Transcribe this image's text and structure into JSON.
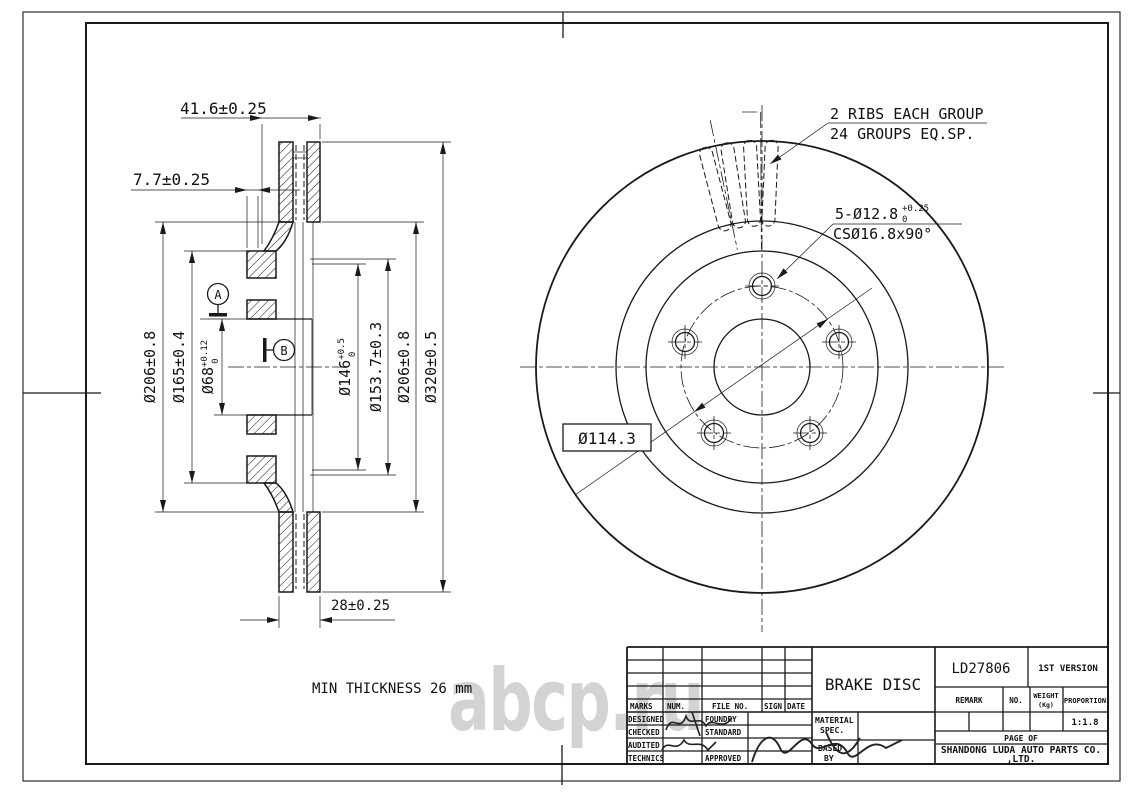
{
  "watermark": "abcp.ru",
  "colors": {
    "line_color": "#1a1a1a",
    "watermark_color": "#b0b0b0"
  },
  "section_view": {
    "dims": {
      "hat_depth": "41.6±0.25",
      "flange_thickness": "7.7±0.25",
      "d206_left": "Ø206±0.8",
      "d165": "Ø165±0.4",
      "d68_base": "Ø68",
      "d68_sup": "+0.12",
      "d68_sub": "0",
      "d146_base": "Ø146",
      "d146_sup": "+0.5",
      "d146_sub": "0",
      "d153_7": "Ø153.7±0.3",
      "d206_right": "Ø206±0.8",
      "d320": "Ø320±0.5",
      "disc_thickness": "28±0.25"
    },
    "datum_a": "A",
    "datum_b": "B",
    "note_min_thickness": "MIN THICKNESS 26 mm"
  },
  "front_view": {
    "ribs_note_line1": "2 RIBS EACH GROUP",
    "ribs_note_line2": "24 GROUPS EQ.SP.",
    "holes_base": "5-Ø12.8",
    "holes_sup": "+0.25",
    "holes_sub": "0",
    "countersink": "CSØ16.8x90°",
    "bolt_circle": "Ø114.3"
  },
  "title_block": {
    "part_name": "BRAKE DISC",
    "drawing_no": "LD27806",
    "version": "1ST VERSION",
    "col_remark": "REMARK",
    "col_no": "NO.",
    "col_weight_1": "WEIGHT",
    "col_weight_2": "(Kg)",
    "col_proportion": "PROPORTION",
    "proportion_value": "1:1.8",
    "page_label": "PAGE  OF",
    "company_line1": "SHANDONG LUDA AUTO PARTS CO.",
    "company_line2": ",LTD.",
    "rev_marks": "MARKS",
    "rev_num": "NUM.",
    "rev_file": "FILE NO.",
    "rev_sign": "SIGN",
    "rev_date": "DATE",
    "role_designed": "DESIGNED",
    "role_checked": "CHECKED",
    "role_audited": "AUDITED",
    "role_technics": "TECHNICS",
    "role_foundry": "FOUNDRY",
    "role_standard": "STANDARD",
    "role_approved": "APPROVED",
    "material_1": "MATERIAL",
    "material_2": "SPEC.",
    "based_1": "BASED",
    "based_2": "BY"
  }
}
